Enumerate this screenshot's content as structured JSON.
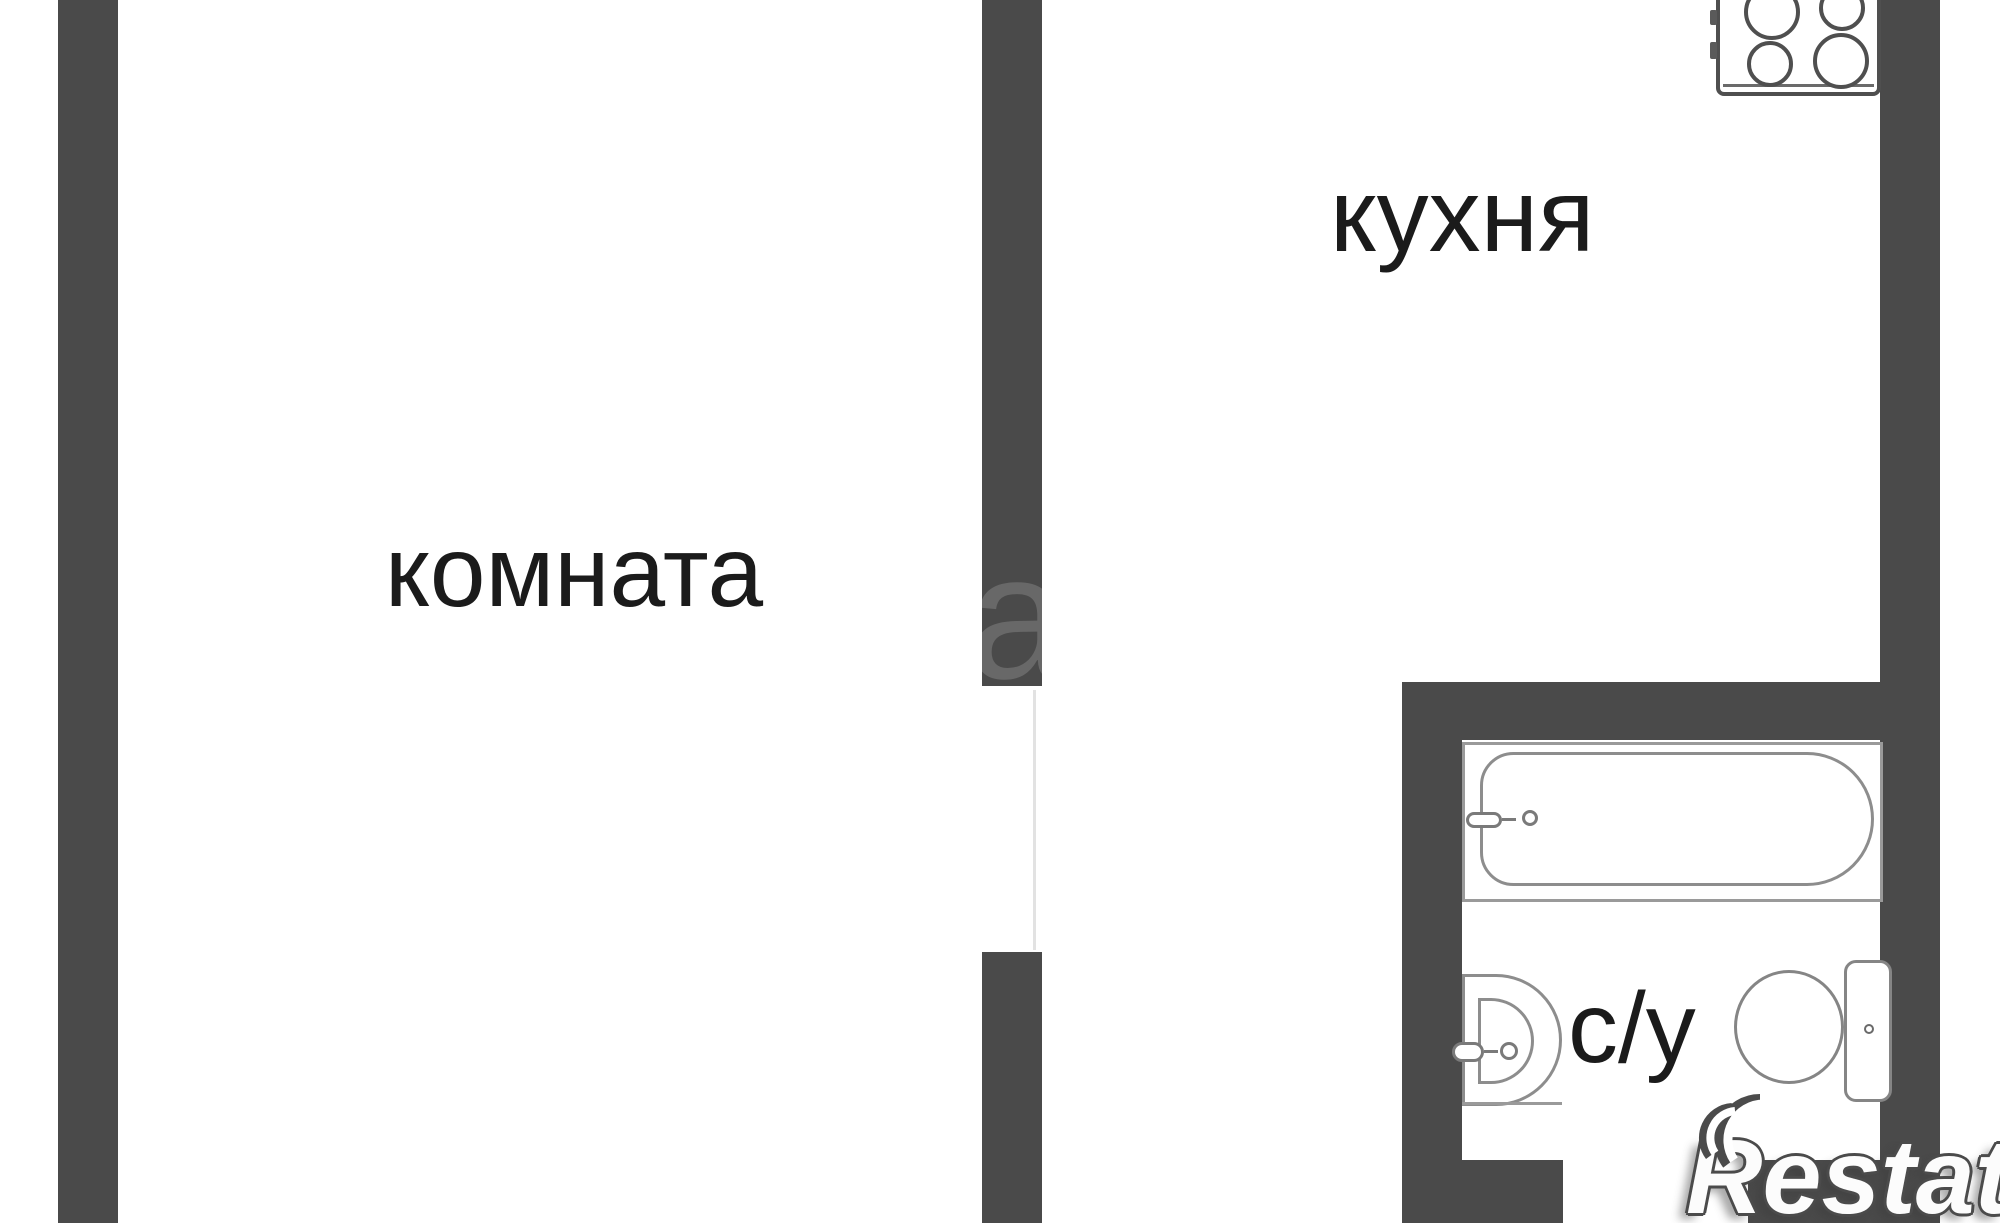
{
  "floor_plan": {
    "rooms": [
      {
        "id": "room",
        "label": "комната"
      },
      {
        "id": "kitchen",
        "label": "кухня"
      },
      {
        "id": "bathroom",
        "label": "с/у"
      }
    ],
    "fixtures": [
      {
        "name": "stove-icon",
        "room": "kitchen",
        "burners": 4
      },
      {
        "name": "bathtub-icon",
        "room": "bathroom"
      },
      {
        "name": "sink-icon",
        "room": "bathroom"
      },
      {
        "name": "toilet-icon",
        "room": "bathroom"
      }
    ],
    "colors": {
      "wall": "#4a4a4a",
      "fixture_outline": "#8d8d8d",
      "label_text": "#1b1b1b",
      "background": "#ffffff",
      "watermark_fill": "#fcfcfc",
      "watermark_shadow": "#4b4b4b"
    },
    "watermark": {
      "brand": "Restate",
      "faint_letter": "a"
    }
  }
}
